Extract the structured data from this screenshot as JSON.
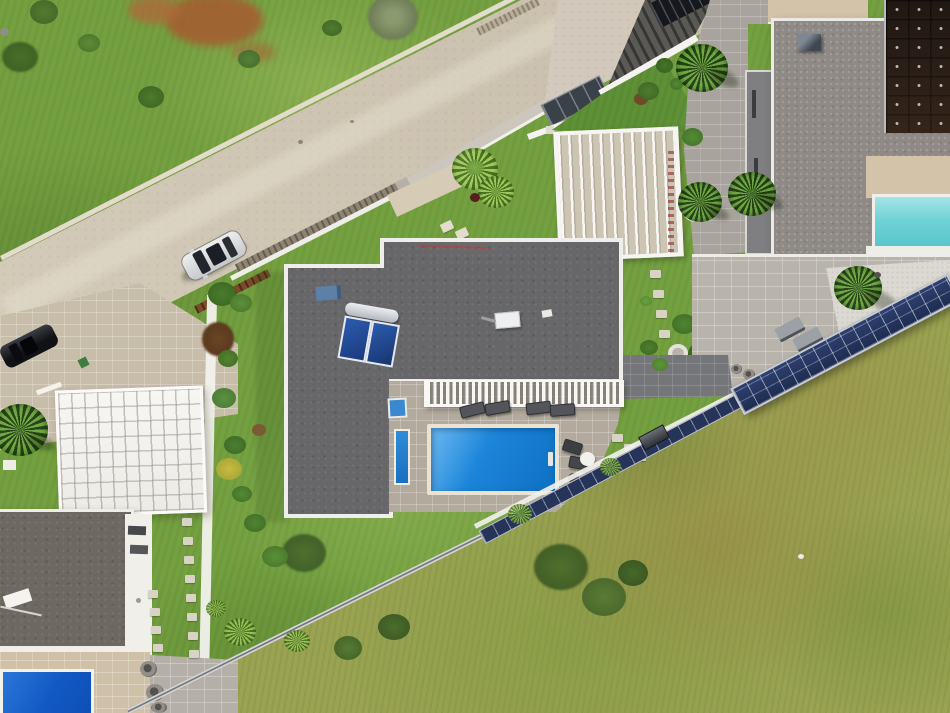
{
  "meta": {
    "type": "aerial-photograph",
    "description": "Top-down drone view of a modern villa neighborhood: flat-roofed houses with gravel roofs, blue and turquoise swimming pools, rooftop solar water heater and PV arrays, a diagonal concrete road with a parked silver car and a black car, white retaining walls, palm trees in round planters, paver patios with sun loungers, and a large grassy field crossed by an inclined rail lined with photovoltaic panels."
  },
  "palette": {
    "grass_base": "#74a140",
    "field_base": "#99a351",
    "road": "#d2c7b4",
    "driveway": "#d9cec0",
    "entry_paving": "#c8bda9",
    "wall_white": "#f2f1ec",
    "wall_stone": "#8d8473",
    "wall_concrete": "#ccc7bd",
    "main_roof": "#67676a",
    "right_roof": "#8f8a86",
    "left_roof": "#6d6862",
    "lower_wing": "#7f7f82",
    "grid_house": "#f3f2ef",
    "facade_white": "#f1efea",
    "patio": "#b2aa9d",
    "right_patio": "#b8b3ab",
    "walkway": "#a8a39d",
    "dark_patio": "#75767a",
    "white_gravel": "#dcd9d2",
    "deck_beige": "#d3c3a9",
    "left_deck": "#cfc1a8",
    "left_pavement": "#b4afa7",
    "pool_main": "#1b84d8",
    "pool_right": "#6fd2d6",
    "pool_left": "#1258c4",
    "lap_pool": "#2f8cd8",
    "solar_pv_blue": "#26345a",
    "solar_array_dark": "#241c16",
    "heater_panel": "#2c5cae",
    "heater_tank": "#c9ccd1",
    "pergola_slat": "#f8f7f4",
    "vent_blue": "#5c80a8",
    "car_silver": "#d9dadc",
    "car_black": "#141518",
    "lounger_dark": "#53555a",
    "lounger_gray": "#9ba1a6",
    "table_white": "#f2f1ee",
    "dirt_red": "#a35f31",
    "rail_gray": "#6a6b6e"
  },
  "objects": {
    "houses": [
      {
        "label": "main L-shaped villa with dark gravel flat roof, solar water heater and pool terrace"
      },
      {
        "label": "right villa with rooftop photovoltaic array and turquoise pool"
      },
      {
        "label": "left villa with white slatted canopy roof and deep blue pool"
      },
      {
        "label": "upper building beside concrete driveway"
      }
    ],
    "pools": [
      {
        "label": "main rectangular blue pool with ladder"
      },
      {
        "label": "narrow lap/plunge strip beside main pool"
      },
      {
        "label": "turquoise pool at right edge"
      },
      {
        "label": "deep blue pool at bottom-left corner"
      }
    ],
    "vehicles": [
      {
        "label": "silver car parked on diagonal road"
      },
      {
        "label": "black car at left property entrance"
      }
    ],
    "counts": {
      "sun_loungers_main_terrace": 4,
      "chairs_main_terrace": 2,
      "sun_loungers_right_patio": 2,
      "palm_planters_walkway": 2,
      "round_pots_bottom_left": 3
    },
    "infrastructure": [
      {
        "label": "inclined rail with photovoltaic panel row crossing the field"
      },
      {
        "label": "funicular cart on rail"
      },
      {
        "label": "white retaining walls along road and gardens"
      },
      {
        "label": "white pergola frames over paver courtyards"
      }
    ]
  }
}
